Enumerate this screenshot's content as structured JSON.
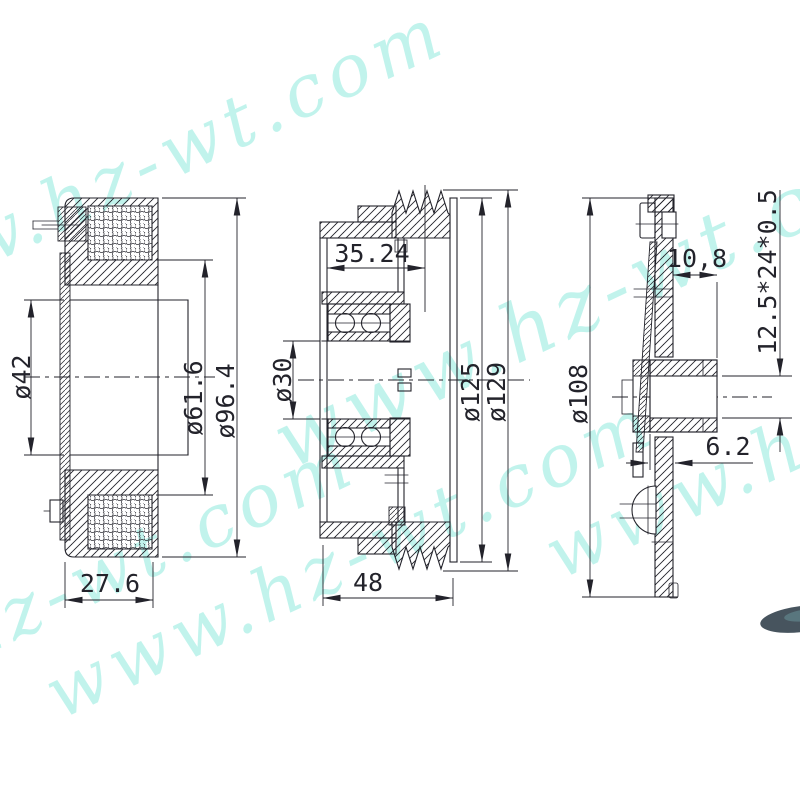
{
  "watermark": {
    "text": "www.hz-wt.com",
    "color": "#8feade"
  },
  "style": {
    "background": "#ffffff",
    "line_color": "#23232b",
    "watermark_color": "#8feade",
    "photo_fragment_color": "#47545e"
  },
  "views": {
    "coil": {
      "dims": {
        "bore": "ø42",
        "coil_inner": "ø61.6",
        "outer": "ø96.4",
        "width": "27.6"
      }
    },
    "pulley": {
      "dims": {
        "groove_offset": "35.24",
        "bore": "ø30",
        "groove_root": "ø125",
        "outer": "ø129",
        "width": "48"
      }
    },
    "hub": {
      "dims": {
        "offset": "10,8",
        "spline": "12.5*24*0.5",
        "outer": "ø108",
        "gap": "6.2"
      }
    }
  }
}
